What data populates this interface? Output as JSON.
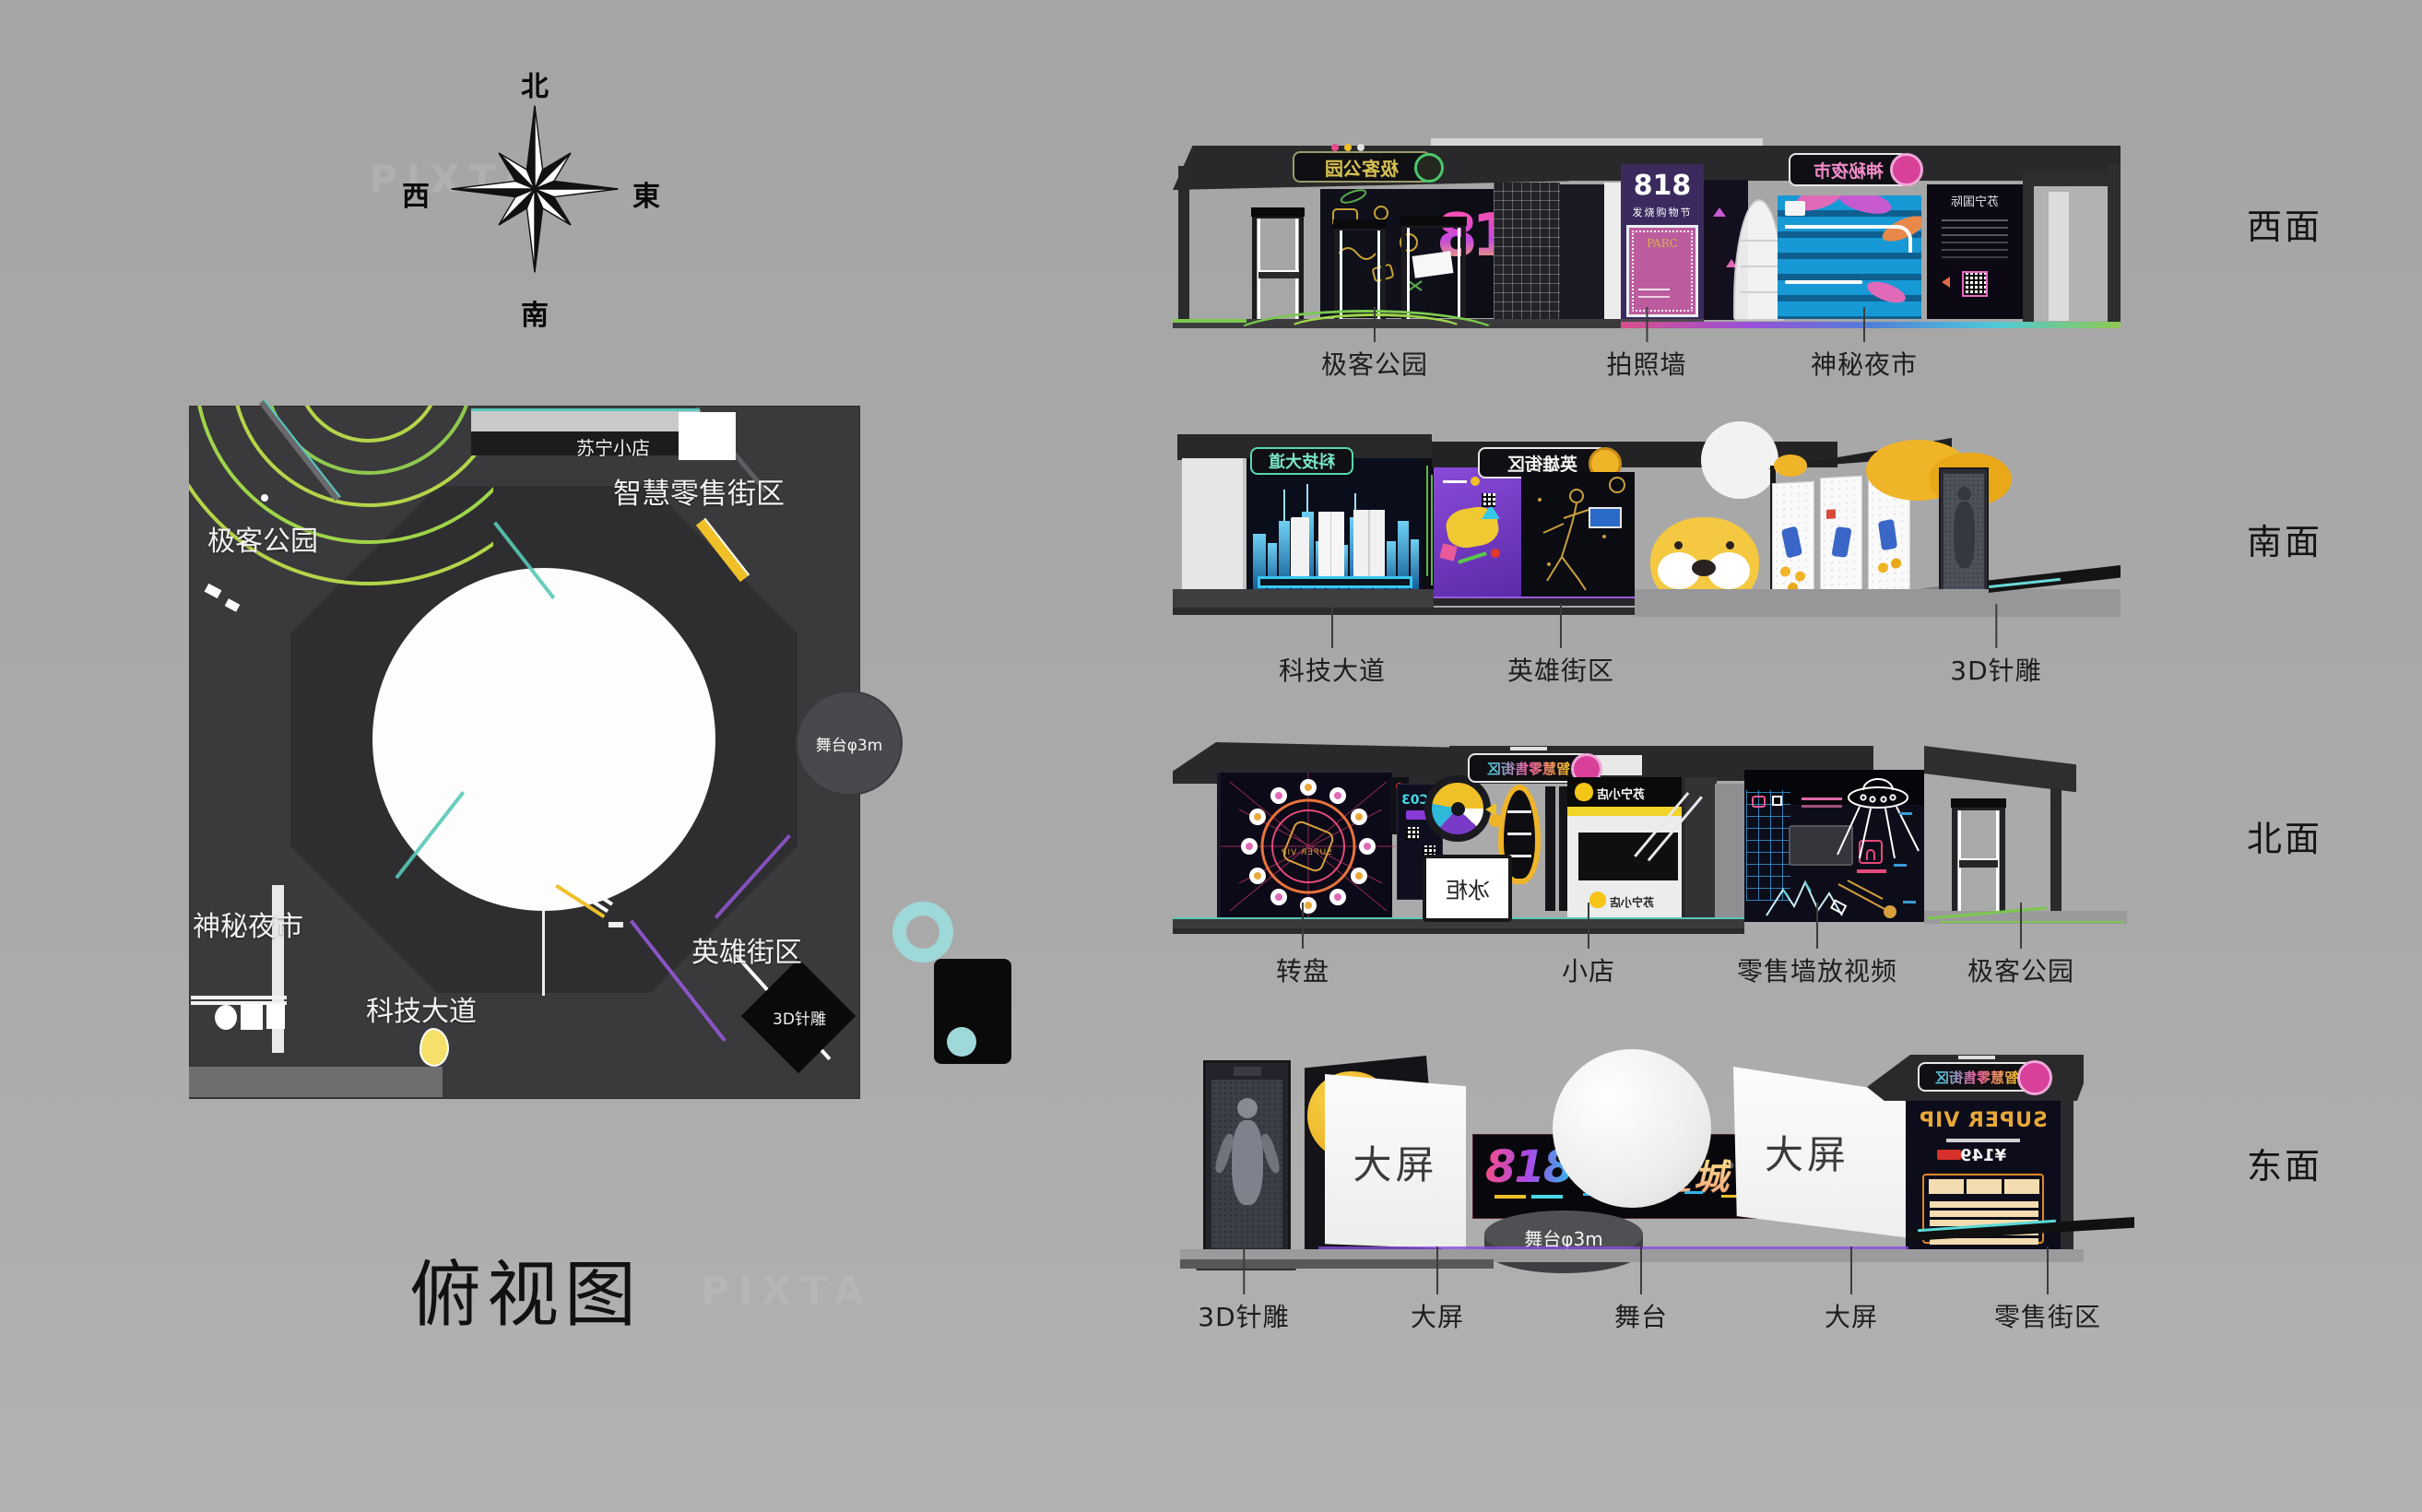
{
  "title": "俯视图",
  "watermark": "PIXTA",
  "compass": {
    "north": "北",
    "south": "南",
    "west": "西",
    "east": "東"
  },
  "plan": {
    "areas": {
      "geek_park": "极客公园",
      "suning_shop": "苏宁小店",
      "smart_retail_street": "智慧零售街区",
      "mystery_night_market": "神秘夜市",
      "tech_avenue": "科技大道",
      "hero_street": "英雄街区",
      "pin_art_3d": "3D针雕",
      "stage": "舞台φ3m"
    }
  },
  "elevations": [
    {
      "id": "west",
      "face": "西面",
      "labels": [
        "极客公园",
        "拍照墙",
        "神秘夜市"
      ]
    },
    {
      "id": "south",
      "face": "南面",
      "labels": [
        "科技大道",
        "英雄街区",
        "3D针雕"
      ]
    },
    {
      "id": "north",
      "face": "北面",
      "labels": [
        "转盘",
        "小店",
        "零售墙放视频",
        "极客公园"
      ]
    },
    {
      "id": "east",
      "face": "东面",
      "labels": [
        "3D针雕",
        "大屏",
        "舞台",
        "大屏",
        "零售街区"
      ]
    }
  ],
  "scene_text": {
    "west": {
      "geek_sign": "极客公园",
      "numerals": "818",
      "photo_num": "818",
      "photo_fest": "发烧购物节",
      "photo_frame": "PARC",
      "night_sign": "神秘夜市",
      "intl_panel": "苏宁国际"
    },
    "south": {
      "tech_sign": "科技大道",
      "hero_sign": "英雄街区"
    },
    "north": {
      "retail_sign": "智慧零售街区",
      "super_vip": "SUPER VIP",
      "screen_code": "AC03",
      "freezer": "冰柜",
      "shop_logo": "苏宁小店"
    },
    "east": {
      "screen_left": "大屏",
      "screen_right": "大屏",
      "numerals": "818",
      "star_city": "超燃星城",
      "stage": "舞台φ3m",
      "retail_sign": "智慧零售街区",
      "super_vip": "SUPER VIP",
      "price": "¥149"
    }
  },
  "colors": {
    "background": "#a9a9a9",
    "accent_pink": "#e84aa0",
    "accent_yellow": "#f0c028",
    "accent_cyan": "#35c8f0",
    "accent_green": "#8fc84f"
  }
}
